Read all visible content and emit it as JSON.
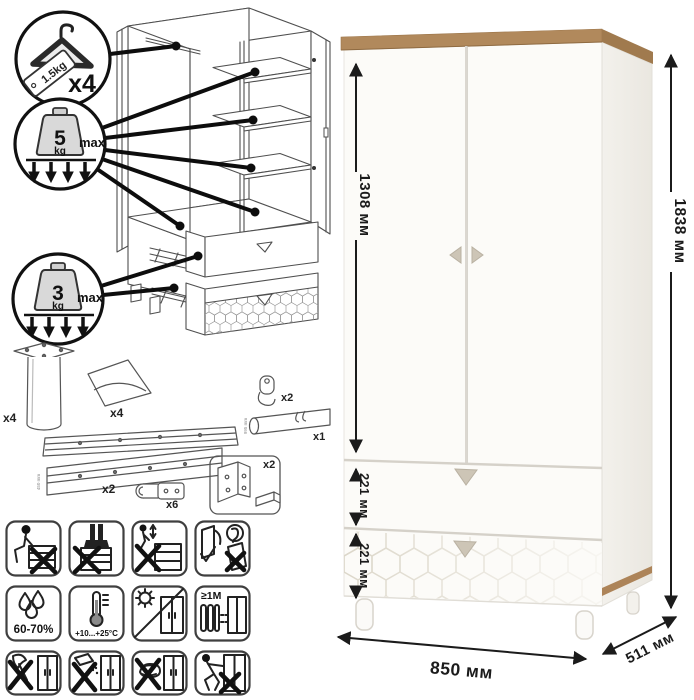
{
  "page": {
    "background": "#ffffff"
  },
  "colors": {
    "wood_top": "#b1895c",
    "body_white": "#fcfbf8",
    "handle_beige": "#cdc5b6",
    "dimension_ink": "#1b1b1b",
    "diagram_ink": "#4f4f4f"
  },
  "assembly": {
    "hanger": {
      "tag": "1.5kg",
      "count": "x4"
    },
    "shelf_load": {
      "value": "5",
      "unit": "kg",
      "qualifier": "max"
    },
    "drawer_load": {
      "value": "3",
      "unit": "kg",
      "qualifier": "max"
    }
  },
  "hardware": {
    "leg": {
      "count": "x4"
    },
    "corner_handle": {
      "count": "x4"
    },
    "rod_holder": {
      "count": "x2"
    },
    "rod": {
      "count": "x1",
      "length": "995 mm"
    },
    "slides": {
      "count": "x2",
      "length": "450 mm"
    },
    "hinges": {
      "count": "x6"
    },
    "brackets": {
      "count": "x2"
    }
  },
  "care": {
    "humidity": "60-70%",
    "temperature": "+10...+25°C",
    "min_distance": "≥1M"
  },
  "dimensions": {
    "door_height": "1308 мм",
    "total_height": "1838 мм",
    "top_drawer": "221 мм",
    "bottom_drawer": "221 мм",
    "width": "850 мм",
    "depth": "511 мм"
  }
}
